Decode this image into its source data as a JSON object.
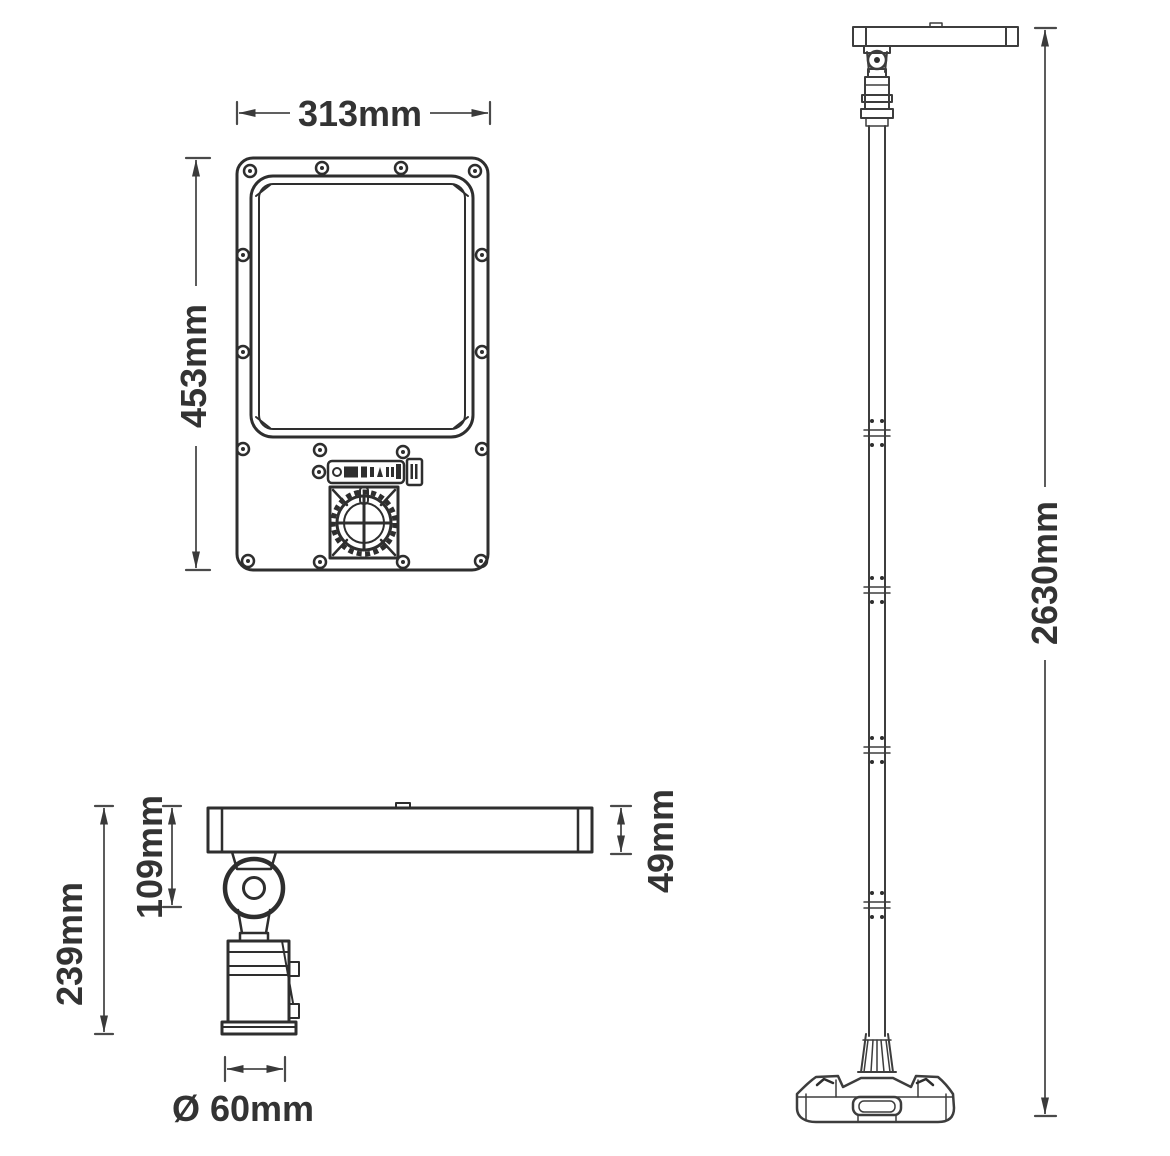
{
  "drawing": {
    "dimensions": {
      "front_width": "313mm",
      "front_height": "453mm",
      "side_height_total": "239mm",
      "side_height_pivot": "109mm",
      "panel_thickness": "49mm",
      "pole_diameter": "Ø 60mm",
      "pole_height": "2630mm"
    },
    "colors": {
      "line": "#2e2e2e",
      "dimension_line": "#4a4a4a",
      "text": "#333333",
      "background": "#ffffff"
    }
  }
}
